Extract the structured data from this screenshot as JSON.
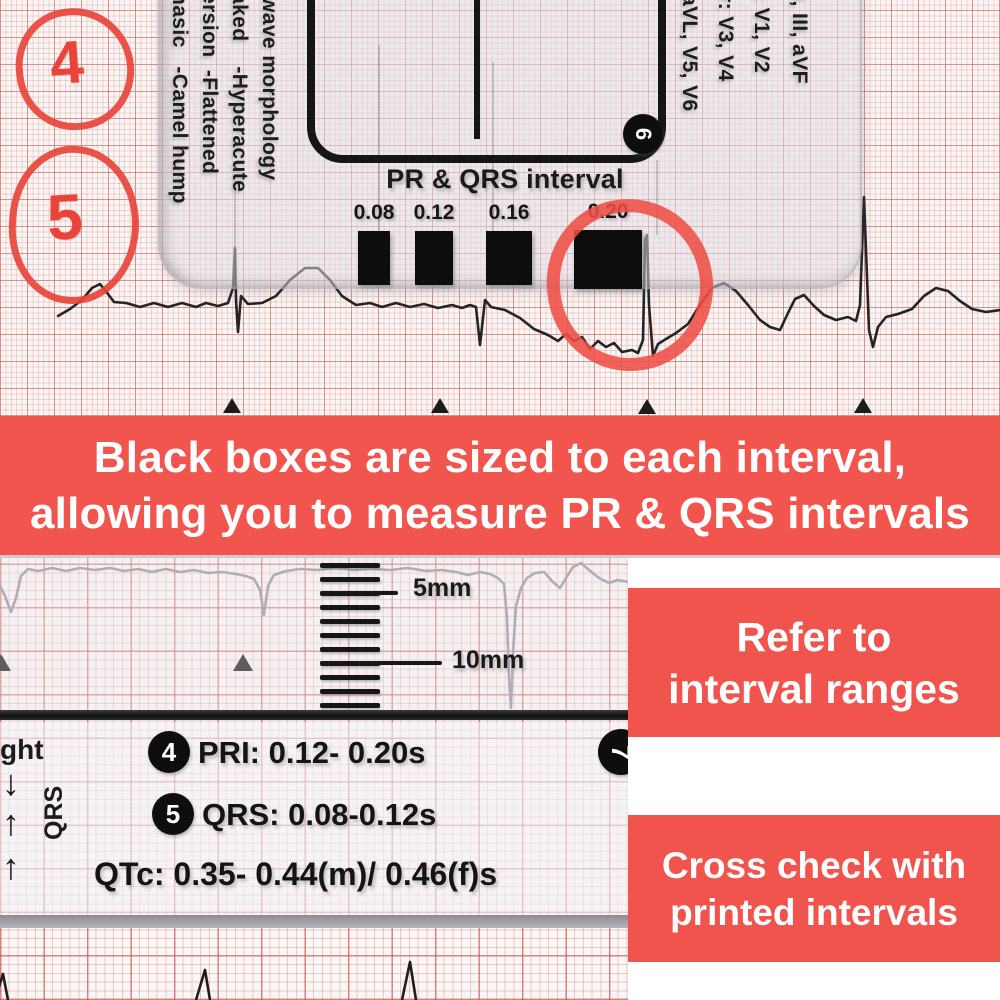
{
  "colors": {
    "banner_red": "#f2544e",
    "callout_red": "#f1534d",
    "marker_red": "#e8443a",
    "ink": "#161616"
  },
  "annotations": {
    "circle4": "4",
    "circle5": "5"
  },
  "ruler_card": {
    "morphology_columns": [
      "hasic   -Camel hump",
      "ersion  -Flattened",
      "aked    -Hyperacute",
      "wave morphology"
    ],
    "lead_columns": [
      "aVL, V5, V6",
      "r: V3, V4",
      ": V1, V2",
      "II, III, aVF"
    ],
    "badge6": "6",
    "interval_section": {
      "title": "PR & QRS interval",
      "boxes": [
        {
          "label": "0.08"
        },
        {
          "label": "0.12"
        },
        {
          "label": "0.16"
        },
        {
          "label": "0.20"
        }
      ]
    }
  },
  "banner": {
    "line1": "Black boxes are sized to each interval,",
    "line2": "allowing you to measure PR & QRS intervals"
  },
  "measure_card": {
    "scale_label_5": "5mm",
    "scale_label_10": "10mm",
    "edge_word": "ght",
    "arrow_down": "↓",
    "arrow_up1": "↑",
    "arrow_up2": "↑",
    "axis_label": "QRS",
    "row4_badge": "4",
    "row4_text": "PRI: 0.12- 0.20s",
    "row5_badge": "5",
    "row5_text": "QRS: 0.08-0.12s",
    "qtc_text": "QTc: 0.35- 0.44(m)/ 0.46(f)s",
    "badge7": "7"
  },
  "callouts": {
    "refer": {
      "line1": "Refer to",
      "line2": "interval ranges"
    },
    "cross": {
      "line1": "Cross check with",
      "line2": "printed intervals"
    }
  }
}
